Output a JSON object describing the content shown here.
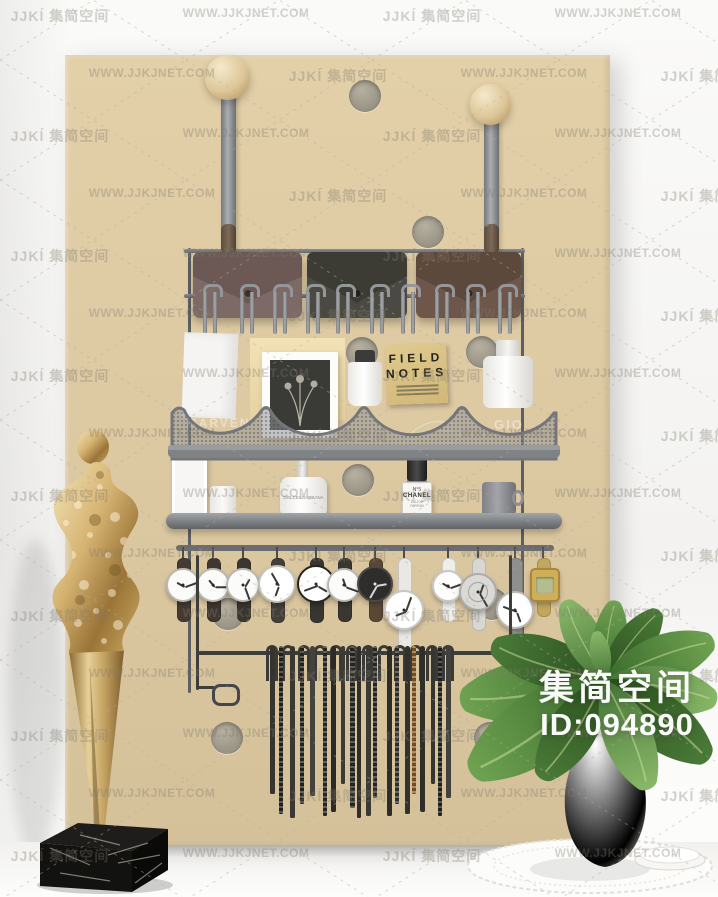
{
  "watermark": {
    "logo": "JJKĺ 集简空间",
    "url": "WWW.JJKJNET.COM"
  },
  "overlay": {
    "brand": "集简空间",
    "id_label": "ID:094890"
  },
  "board": {
    "color": "#ddc9a2",
    "holes": [
      [
        365,
        96
      ],
      [
        428,
        232
      ],
      [
        362,
        353
      ],
      [
        482,
        352
      ],
      [
        358,
        480
      ],
      [
        228,
        614
      ],
      [
        492,
        604
      ],
      [
        227,
        738
      ],
      [
        490,
        738
      ]
    ]
  },
  "rack": {
    "pouches": [
      {
        "x": 193,
        "w": 109,
        "body": "#7d6a66",
        "flap": "#6c5854"
      },
      {
        "x": 307,
        "w": 100,
        "body": "#4a4a42",
        "flap": "#3c3c35"
      },
      {
        "x": 416,
        "w": 105,
        "body": "#6e564a",
        "flap": "#5d483c"
      }
    ],
    "hook_xs": [
      210,
      247,
      280,
      313,
      343,
      377,
      408,
      442,
      473,
      505
    ],
    "watches": [
      {
        "x": 183,
        "y": 585,
        "r": 17,
        "strap": "#453b33",
        "case": "#b9b7b2",
        "face": "#fbfbf9",
        "type": "plain"
      },
      {
        "x": 213,
        "y": 585,
        "r": 17,
        "strap": "#403830",
        "case": "#b9b7b2",
        "face": "#fbfbf9",
        "type": "plain"
      },
      {
        "x": 243,
        "y": 585,
        "r": 17,
        "strap": "#3b3630",
        "case": "#b9b7b2",
        "face": "#fbfbf9",
        "type": "plain"
      },
      {
        "x": 277,
        "y": 584,
        "r": 19,
        "strap": "#453f39",
        "case": "#c4c2bd",
        "face": "#ffffff",
        "type": "plain"
      },
      {
        "x": 316,
        "y": 584,
        "r": 19,
        "strap": "#393531",
        "case": "#26241f",
        "face": "#ffffff",
        "type": "plain"
      },
      {
        "x": 344,
        "y": 585,
        "r": 17,
        "strap": "#3a3631",
        "case": "#b9b7b2",
        "face": "#fbfbf9",
        "type": "plain"
      },
      {
        "x": 375,
        "y": 584,
        "r": 18,
        "strap": "#5b4736",
        "case": "#4a4845",
        "face": "#2f2d2b",
        "type": "dark"
      },
      {
        "x": 404,
        "y": 610,
        "r": 20,
        "strap": "#eae8e4",
        "case": "#c9c7c2",
        "face": "#ffffff",
        "type": "long"
      },
      {
        "x": 448,
        "y": 586,
        "r": 16,
        "strap": "#efeeea",
        "case": "#c9c7c2",
        "face": "#fdfdfc",
        "type": "plain"
      },
      {
        "x": 478,
        "y": 592,
        "r": 19,
        "strap": "#d8d7d3",
        "case": "#adaca8",
        "face": "#dad9d5",
        "type": "skeleton"
      },
      {
        "x": 515,
        "y": 610,
        "r": 19,
        "strap": "#8f8f8d",
        "case": "#bdbbb6",
        "face": "#ffffff",
        "type": "long"
      },
      {
        "x": 543,
        "y": 583,
        "r": 14,
        "strap": "#c2a75e",
        "case": "#a8863c",
        "face": "#cfae58",
        "type": "digital"
      }
    ],
    "belt_loop_xs": [
      272,
      288,
      304,
      320,
      336,
      352,
      368,
      384,
      400,
      416,
      432,
      448
    ],
    "belts": [
      [
        272,
        148,
        5,
        "#35342f",
        0
      ],
      [
        281,
        168,
        4,
        "#2c2b27",
        1
      ],
      [
        292,
        172,
        5,
        "#3a3833",
        0
      ],
      [
        302,
        158,
        4,
        "#2f2e2a",
        1
      ],
      [
        312,
        150,
        5,
        "#44423c",
        0
      ],
      [
        325,
        170,
        4,
        "#35332e",
        1
      ],
      [
        333,
        166,
        5,
        "#2b2a26",
        0
      ],
      [
        343,
        138,
        4,
        "#3c3a34",
        0
      ],
      [
        352,
        162,
        5,
        "#31302b",
        1
      ],
      [
        359,
        172,
        4,
        "#2e2d29",
        0
      ],
      [
        368,
        170,
        5,
        "#3b3933",
        0
      ],
      [
        375,
        152,
        4,
        "#34322d",
        1
      ],
      [
        389,
        170,
        5,
        "#2d2c28",
        0
      ],
      [
        397,
        158,
        4,
        "#403e38",
        1
      ],
      [
        407,
        168,
        5,
        "#32312c",
        0
      ],
      [
        414,
        148,
        4,
        "#9a6a33",
        1
      ],
      [
        422,
        166,
        5,
        "#2f2e29",
        0
      ],
      [
        433,
        138,
        4,
        "#37352f",
        0
      ],
      [
        440,
        170,
        4,
        "#2c2b27",
        1
      ],
      [
        448,
        152,
        5,
        "#41403a",
        0
      ]
    ]
  },
  "products": {
    "field_notes": {
      "line1": "FIELD",
      "line2": "NOTES"
    },
    "chanel": {
      "no": "N°5",
      "name": "CHANEL",
      "sub": "EAU DE PARFUM"
    },
    "dolce": {
      "label": "DOLCE&GABBANA"
    },
    "carven": "CARVEN",
    "gio": "GIO"
  },
  "palette": {
    "board": "#ddc9a2",
    "gold": "#caa55c",
    "marble": "#141414",
    "leaf_dark": "#2c501f",
    "leaf_mid": "#4a7a38",
    "leaf_light": "#6fa251",
    "metal": "#7d8083",
    "leather": "#6e564a"
  }
}
